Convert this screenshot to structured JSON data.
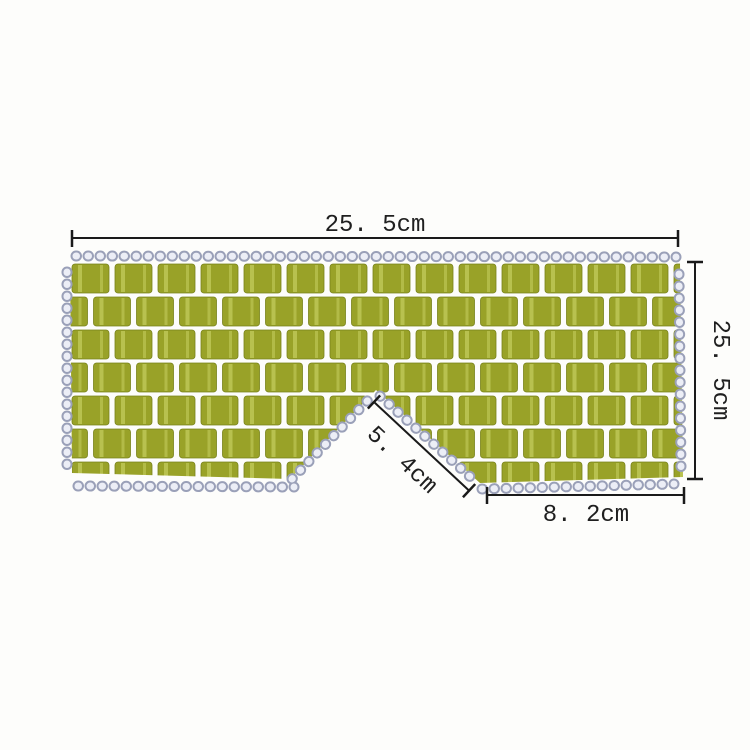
{
  "annotations": {
    "top_width": "25. 5cm",
    "right_height": "25. 5cm",
    "nose_bridge": "5. 4cm",
    "bottom_right_width": "8. 2cm"
  },
  "colors": {
    "background": "#fdfdfb",
    "tile_green": "#99a228",
    "tile_green_dark": "#78821a",
    "tile_streak": "#c3cb5c",
    "bead_outline": "#9aa0b8",
    "bead_fill": "#eceef6",
    "dimension_line": "#1a1a1a",
    "label_text": "#1f1f1f"
  }
}
